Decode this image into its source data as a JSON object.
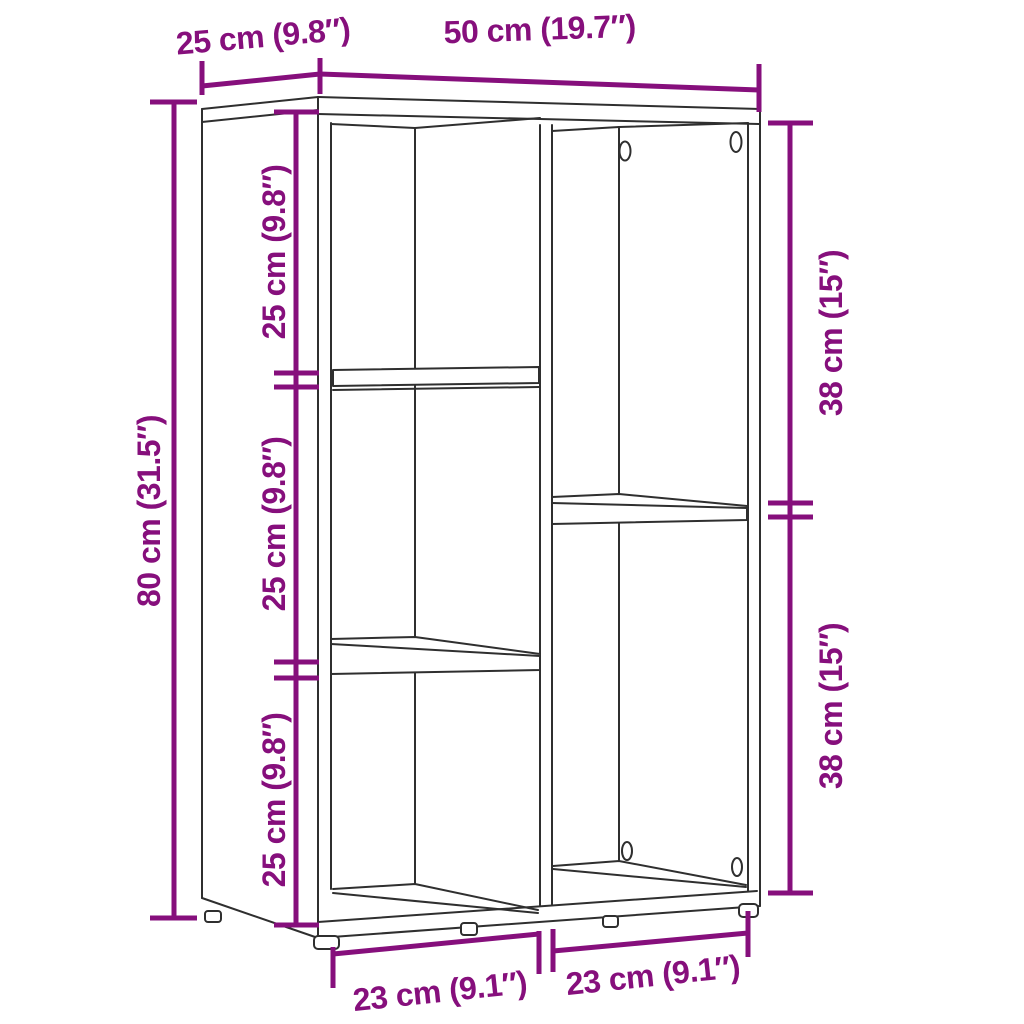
{
  "diagram": {
    "type": "furniture-dimension-diagram",
    "colors": {
      "dimension_accent": "#860f7c",
      "outline": "#2f2f2f",
      "background": "#ffffff"
    },
    "labels": {
      "top_depth": "25 cm (9.8″)",
      "top_width": "50 cm (19.7″)",
      "side_height": "80 cm (31.5″)",
      "left_cube_1": "25 cm (9.8″)",
      "left_cube_2": "25 cm (9.8″)",
      "left_cube_3": "25 cm (9.8″)",
      "right_section_1": "38 cm (15″)",
      "right_section_2": "38 cm (15″)",
      "bottom_left_width": "23 cm (9.1″)",
      "bottom_right_width": "23 cm (9.1″)"
    }
  }
}
